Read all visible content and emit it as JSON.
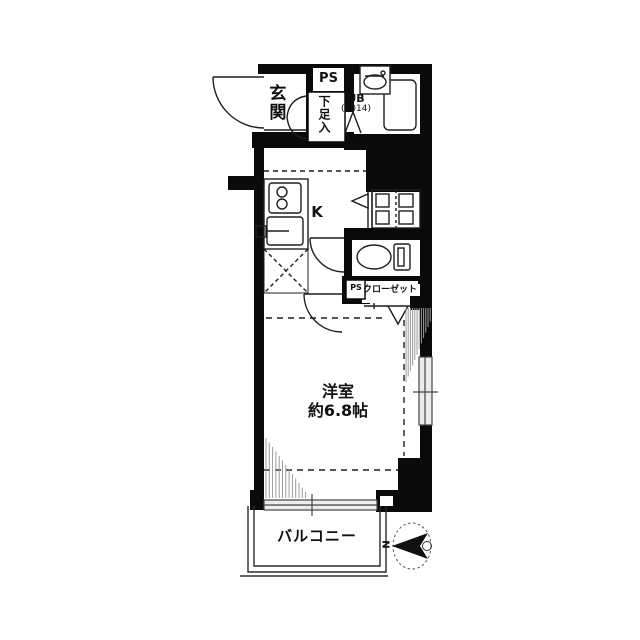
{
  "floorplan": {
    "labels": {
      "entrance": "玄関",
      "pipe_space_top": "PS",
      "shoe_storage": "下足入",
      "unit_bath": "UB",
      "unit_bath_size": "(1014)",
      "kitchen": "K",
      "pipe_space_mid": "PS",
      "closet": "クローゼット",
      "room_name": "洋室",
      "room_size": "約6.8帖",
      "balcony": "バルコニー",
      "compass_north": "N"
    },
    "colors": {
      "wall": "#0a0a0a",
      "line": "#1f1f1f",
      "hatch": "#9b9b9b",
      "background": "#ffffff"
    }
  }
}
